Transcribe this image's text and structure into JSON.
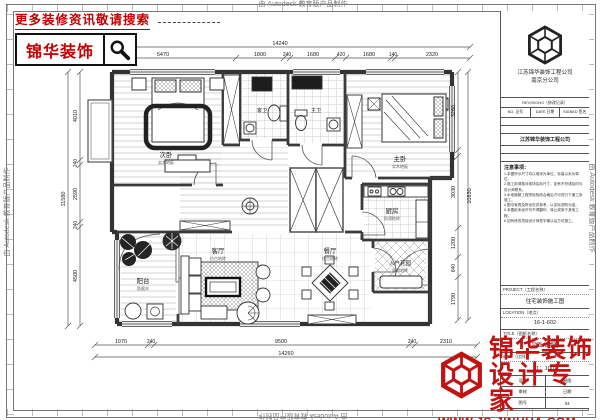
{
  "stamps": {
    "autodesk": "由 Autodesk 教育版产品制作"
  },
  "promo": {
    "headline": "更多装修资讯敬请搜索",
    "brand": "锦华装饰"
  },
  "brand_overlay": {
    "line1": "锦华装饰",
    "line2": "设计专家",
    "url": "WWW.JS-JINHUA.COM"
  },
  "title_block": {
    "company_name": "江苏锦华装饰工程公司",
    "company_branch": "南京分公司",
    "rev_title": "REVISIONS（修改记录）",
    "rev_no": "NO. 记号",
    "rev_date": "DATE 日期",
    "rev_signed": "SIGNED 签名",
    "company_row": "江苏锦华装饰工程公司",
    "notes_title": "注意事项：",
    "notes": [
      "1.本图所示尺寸均以毫米为单位，标高以米为单位。",
      "2.施工前请核对现场实际尺寸，如有不符请及时与设计师联系。",
      "3.水电隐蔽工程须经验收合格后方可进行下道工序施工。",
      "4.图中家具及陈设仅供参考，以实际选购为准。",
      "5.本图纸未经许可不得翻印、转让或用于其他工程。",
      "6.如有修改须经设计师签字确认后方可施工。"
    ],
    "project_label": "PROJECT（工程名称）",
    "project_value": "住宅装饰施工图",
    "location_label": "LOCATION（地点）",
    "location_value": "16-1-602",
    "sheet_label": "TITLE（图纸名称）",
    "sheet_value": "平面布置图",
    "scale_label": "scale（比例）",
    "scale_value": "1：100",
    "design_label": "设计",
    "draw_label": "制图",
    "check_label": "审核",
    "date_label": "日期",
    "no_label": "图号",
    "no_value": "04"
  },
  "plan": {
    "rooms": {
      "bedroom2": "次卧",
      "master": "主卧",
      "living": "客厅",
      "dining": "餐厅",
      "kitchen": "厨房",
      "balcony": "阳台",
      "entry": "入户花园",
      "bath1": "客卫",
      "bath2": "主卫"
    },
    "subs": {
      "bedroom2": "实木地板",
      "master": "实木地板",
      "living": "仿古地砖",
      "dining": "仿古地砖",
      "kitchen": "防滑地砖",
      "balcony": "防腐木",
      "entry": "防滑地砖"
    },
    "dims": {
      "top": {
        "total": "14240",
        "s": [
          "5470",
          "1800",
          "240",
          "1680",
          "420",
          "1680",
          "140",
          "2320"
        ]
      },
      "bottom": {
        "total": "14260",
        "s": [
          "1970",
          "240",
          "9500",
          "240",
          "2310"
        ]
      },
      "left": {
        "total": "11580",
        "s": [
          "4010",
          "240",
          "2590",
          "240",
          "4500"
        ]
      },
      "right": {
        "total": "10830",
        "s": [
          "3260",
          "240",
          "3030",
          "1200",
          "840",
          "1790"
        ]
      }
    }
  }
}
